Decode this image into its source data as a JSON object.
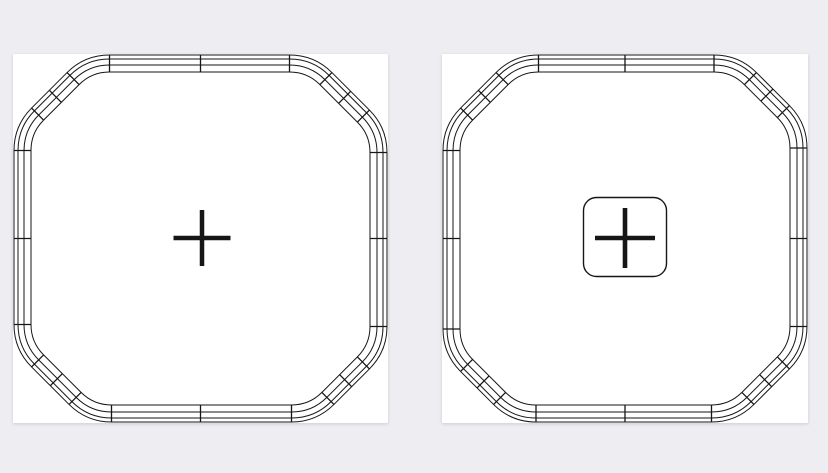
{
  "scene": {
    "width": 828,
    "height": 473,
    "background_color": "#EDEDF2",
    "panel_color": "#FFFFFF",
    "panel_shadow": "0 1px 3px rgba(40,40,70,0.16)",
    "line_color": "#161616"
  },
  "track_style": {
    "outline_insets": [
      0,
      4,
      10,
      17
    ],
    "band_width": 17,
    "flat_half_length_x": 89,
    "flat_half_length_y": 88,
    "corner_radius": 60,
    "margin": 1,
    "outline_stroke": 1,
    "tick_stroke": 1.3,
    "straight_pieces_per_side": 2,
    "pieces_per_corner": 4
  },
  "panels": [
    {
      "name": "track-plan-left",
      "x": 13,
      "y": 54,
      "width": 375,
      "height": 369,
      "marker": {
        "kind": "crosshair",
        "cx": 189,
        "cy": 184,
        "arm_span_x": 57,
        "arm_span_y": 56,
        "thickness": 4.5
      }
    },
    {
      "name": "track-plan-right",
      "x": 442,
      "y": 54,
      "width": 366,
      "height": 369,
      "marker": {
        "kind": "crosshair-button",
        "cx": 183,
        "cy": 184,
        "arm_span_x": 60,
        "arm_span_y": 60,
        "thickness": 4.6,
        "button_box": {
          "width": 83,
          "height": 79,
          "radius": 13,
          "stroke": 1.4,
          "cy_offset": -1
        }
      }
    }
  ]
}
